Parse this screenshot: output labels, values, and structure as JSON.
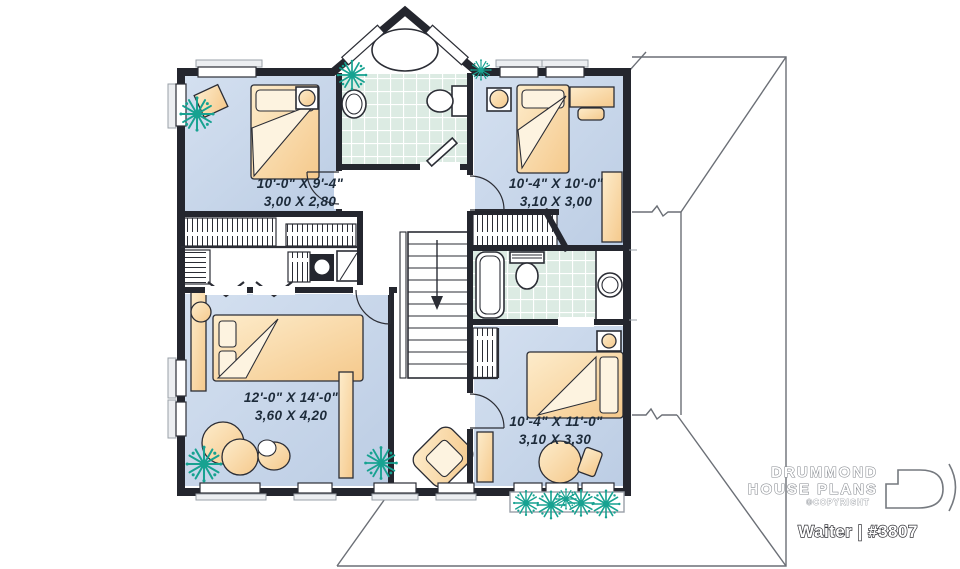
{
  "branding": {
    "name_line1": "DRUMMOND",
    "name_line2": "HOUSE PLANS",
    "copyright": "©COPYRIGHT",
    "plan_title": "Waiter | #3807",
    "logo_icon": "drummond-d-icon"
  },
  "floor_plan": {
    "rooms": [
      {
        "id": "bedroom-top-left",
        "imperial": "10'-0\" X 9'-4\"",
        "metric": "3,00 X 2,80"
      },
      {
        "id": "bedroom-top-right",
        "imperial": "10'-4\" X 10'-0\"",
        "metric": "3,10 X 3,00"
      },
      {
        "id": "master-bedroom",
        "imperial": "12'-0\" X 14'-0\"",
        "metric": "3,60 X 4,20"
      },
      {
        "id": "bedroom-bottom-right",
        "imperial": "10'-4\" X 11'-0\"",
        "metric": "3,10 X 3,30"
      }
    ],
    "icons": [
      "plant-icon",
      "bed-icon",
      "bathtub-icon",
      "toilet-icon",
      "sink-icon",
      "stairs-icon",
      "closet-rack-icon",
      "armchair-icon",
      "window-icon",
      "door-icon",
      "washer-icon",
      "nightstand-icon",
      "desk-icon",
      "dresser-icon",
      "round-table-icon"
    ],
    "colors": {
      "wall": "#24262e",
      "floor_blue": "#c6d4e8",
      "furniture_peach": "#f8d9a3",
      "tile_green": "#dcebe3",
      "plant_teal": "#17a291",
      "roof_line": "#6b6f76",
      "label_text": "#1d2b3a",
      "background": "#ffffff"
    }
  }
}
